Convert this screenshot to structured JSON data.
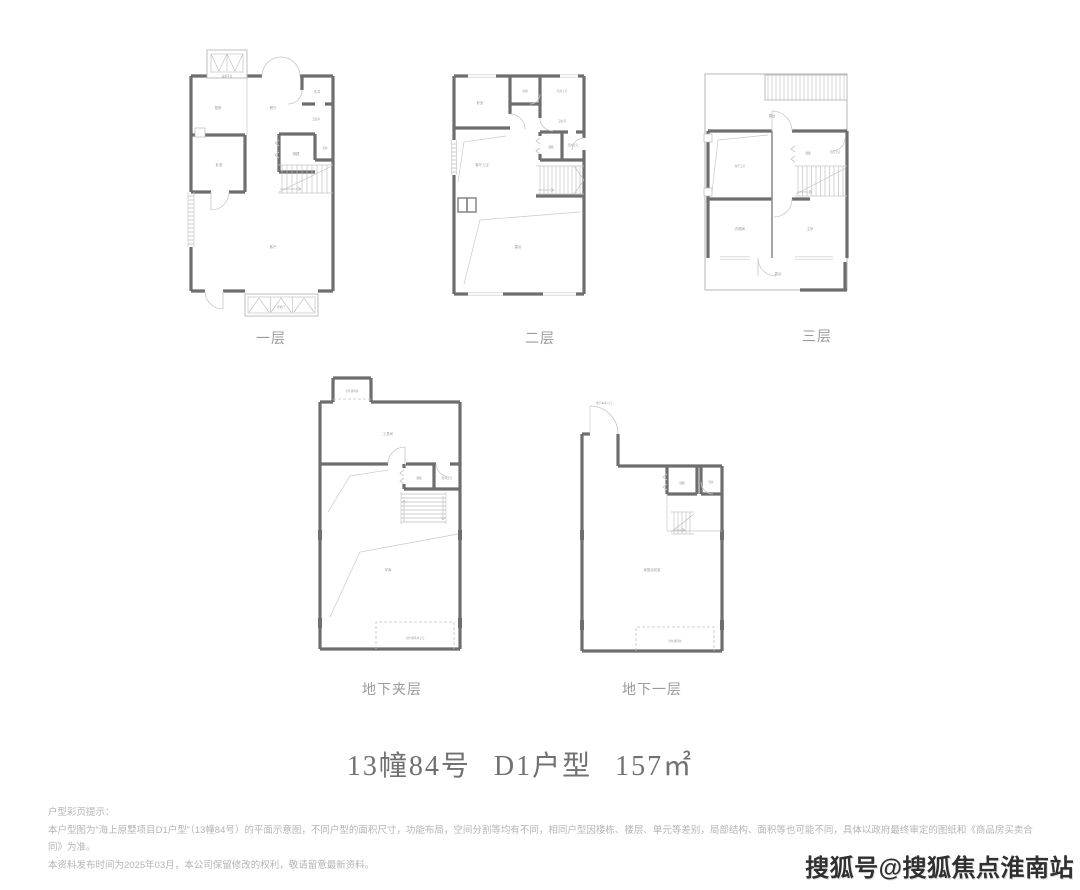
{
  "page": {
    "title": "13幢84号 D1户型 157㎡",
    "watermark": "搜狐号@搜狐焦点淮南站",
    "disclaimer": {
      "line1": "户型彩页提示：",
      "line2": "本户型图为“海上原墅项目D1户型”（13幢84号）的平面示意图，不同户型的面积尺寸，功能布局，空间分割等均有不同，相同户型因楼栋、楼层、单元等差别，局部结构、面积等也可能不同，具体以政府最终审定的图纸和《商品房买卖合同》为准。",
      "line3": "本资料发布时间为2025年03月，本公司保留修改的权利，敬请留意最新资料。"
    }
  },
  "plans": {
    "f1": {
      "name": "一层",
      "rooms": [
        "设备平台",
        "厨房",
        "餐厅",
        "天井",
        "卫生间",
        "储藏",
        "天井",
        "卧室",
        "客厅",
        "折叠门"
      ]
    },
    "f2": {
      "name": "二层",
      "rooms": [
        "卧室",
        "衣帽",
        "天井上空",
        "卫生间",
        "客厅上空",
        "储藏",
        "天井上空",
        "露台"
      ]
    },
    "f3": {
      "name": "三层",
      "rooms": [
        "露台",
        "客厅上空",
        "储藏",
        "天井上空",
        "衣帽间",
        "主卧",
        "露台"
      ]
    },
    "b0": {
      "name": "地下夹层",
      "rooms": [
        "室外通风井",
        "工具间",
        "储藏",
        "管井上空",
        "车库",
        "室外通风井上空"
      ]
    },
    "b1": {
      "name": "地下一层",
      "rooms": [
        "地下车库入口",
        "储藏",
        "管井",
        "家庭活动室",
        "室外通风井"
      ]
    }
  }
}
